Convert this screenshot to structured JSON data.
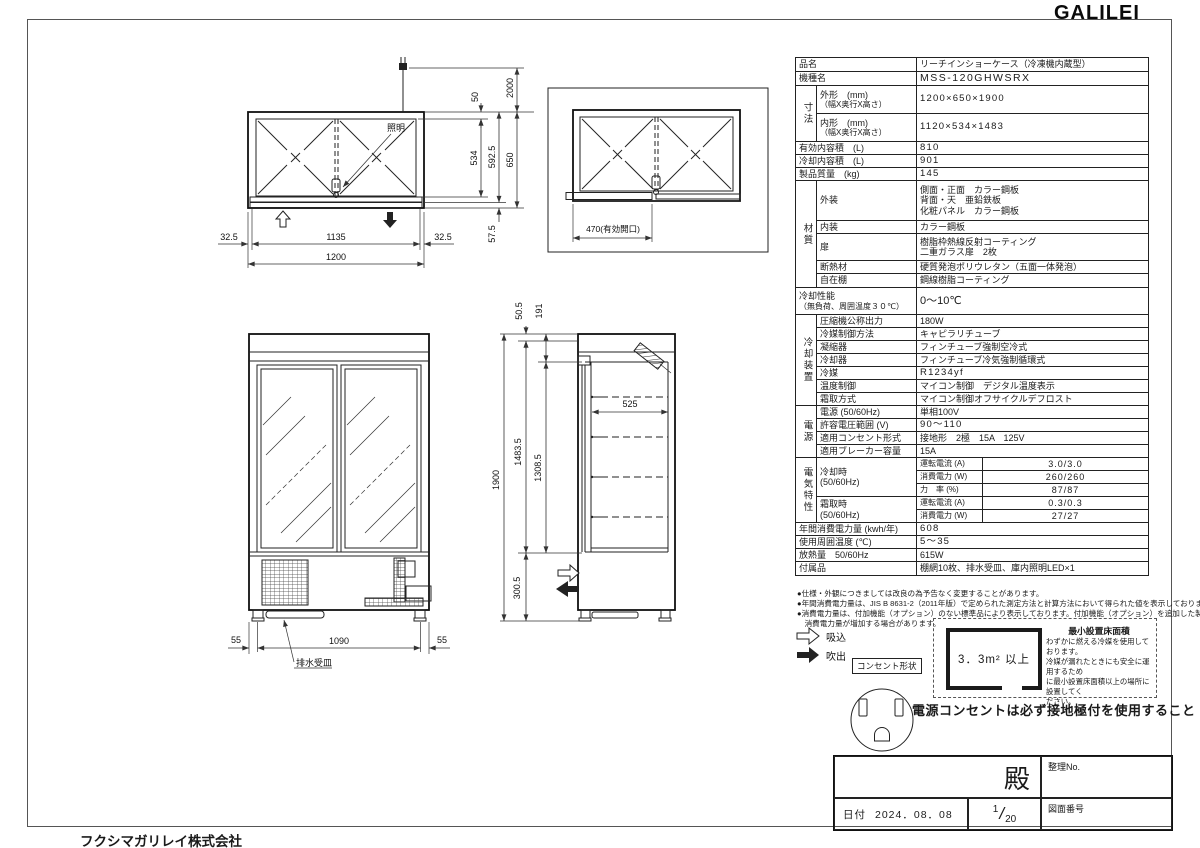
{
  "colors": {
    "ink": "#1a1a1a",
    "paper": "#ffffff"
  },
  "logo": "GALILEI",
  "company": "フクシマガリレイ株式会社",
  "spec": {
    "hinmei": {
      "label": "品名",
      "value": "リーチインショーケース（冷凍機内蔵型）"
    },
    "kishumei": {
      "label": "機種名",
      "value": "MSS-120GHWSRX"
    },
    "sunpou_group": "寸法",
    "gaikei": {
      "label": "外形　(mm)",
      "sub": "（幅X奥行X高さ）",
      "value": "1200×650×1900"
    },
    "naikei": {
      "label": "内形　(mm)",
      "sub": "（幅X奥行X高さ）",
      "value": "1120×534×1483"
    },
    "yuko_naiyoseki": {
      "label": "有効内容積　(L)",
      "value": "810"
    },
    "reikyaku_naiyoseki": {
      "label": "冷却内容積　(L)",
      "value": "901"
    },
    "seihin_shitsuryo": {
      "label": "製品質量　(kg)",
      "value": "145"
    },
    "zaishitsu_group": "材質",
    "gaisou": {
      "label": "外装",
      "lines": [
        "側面・正面　カラー鋼板",
        "背面・天　亜鉛鉄板",
        "化粧パネル　カラー鋼板"
      ]
    },
    "naisou": {
      "label": "内装",
      "value": "カラー鋼板"
    },
    "tobira": {
      "label": "扉",
      "lines": [
        "樹脂枠熱線反射コーティング",
        "二重ガラス扉　2枚"
      ]
    },
    "dannetsuzai": {
      "label": "断熱材",
      "value": "硬質発泡ポリウレタン（五面一体発泡）"
    },
    "jizaidana": {
      "label": "自在棚",
      "value": "鋼線樹脂コーティング"
    },
    "reikyaku_seino": {
      "label": "冷却性能",
      "sub": "（無負荷、周囲温度３０℃）",
      "value": "0～10℃"
    },
    "sochi_group": "冷却装置",
    "asshukuki": {
      "label": "圧縮機公称出力",
      "value": "180W"
    },
    "reibai_seigyo": {
      "label": "冷媒制御方法",
      "value": "キャピラリチューブ"
    },
    "gyoshukuki": {
      "label": "凝縮器",
      "value": "フィンチューブ強制空冷式"
    },
    "reikyakuki": {
      "label": "冷却器",
      "value": "フィンチューブ冷気強制循環式"
    },
    "reibai": {
      "label": "冷媒",
      "value": "R1234yf"
    },
    "ondo_seigyo": {
      "label": "温度制御",
      "value": "マイコン制御　デジタル温度表示"
    },
    "shimotori": {
      "label": "霜取方式",
      "value": "マイコン制御オフサイクルデフロスト"
    },
    "dengen_group": "電源",
    "dengen": {
      "label": "電源 (50/60Hz)",
      "value": "単相100V"
    },
    "kyoyo_denatsu": {
      "label": "許容電圧範囲 (V)",
      "value": "90～110"
    },
    "consent_keishiki": {
      "label": "適用コンセント形式",
      "value": "接地形　2極　15A　125V"
    },
    "breaker": {
      "label": "適用ブレーカー容量",
      "value": "15A"
    },
    "denki_group": "電気特性",
    "reikyakuji": {
      "label": "冷却時",
      "sub": "(50/60Hz)"
    },
    "shimotoriji": {
      "label": "霜取時",
      "sub": "(50/60Hz)"
    },
    "unten_denryu": "運転電流 (A)",
    "shohi_denryoku": "消費電力 (W)",
    "rikiritsu": "力　率 (%)",
    "cool_current": "3.0/3.0",
    "cool_power": "260/260",
    "cool_pf": "87/87",
    "defrost_current": "0.3/0.3",
    "defrost_power": "27/27",
    "nenkan": {
      "label": "年間消費電力量 (kwh/年)",
      "value": "608"
    },
    "shiyo_ondo": {
      "label": "使用周囲温度 (℃)",
      "value": "5～35"
    },
    "hounetsu": {
      "label": "放熱量　50/60Hz",
      "value": "615W"
    },
    "fuzokuhin": {
      "label": "付属品",
      "value": "棚網10枚、排水受皿、庫内照明LED×1"
    }
  },
  "notes_lines": [
    "●仕様・外観につきましては改良の為予告なく変更することがあります。",
    "●年間消費電力量は、JIS B 8631-2（2011年版）で定められた測定方法と計算方法において得られた値を表示しております",
    "●消費電力量は、付加機能（オプション）のない標準品により表示しております。付加機能（オプション）を追加した製品は、",
    "　消費電力量が増加する場合があります。"
  ],
  "legend": {
    "suction": "吸込",
    "blowout": "吹出"
  },
  "outlet_label": "コンセント形状",
  "ground_note": "電源コンセントは必ず接地極付を使用すること",
  "min_area": {
    "title": "最小設置床面積",
    "area": "3．3m² 以上",
    "note_lines": [
      "わずかに燃える冷媒を使用しております。",
      "冷媒が漏れたときにも安全に運用するため",
      "に最小設置床面積以上の場所に設置してく",
      "ださい。"
    ]
  },
  "title_block": {
    "dono": "殿",
    "seiri": "整理No.",
    "date_label": "日付",
    "date": "2024．08．08",
    "scale_num": "1",
    "scale_den": "20",
    "zuban": "図面番号"
  },
  "dims": {
    "lighting": "照明",
    "d50": "50",
    "d2000": "2000",
    "d534": "534",
    "d592_5": "592.5",
    "d650": "650",
    "d57_5": "57.5",
    "d32_5": "32.5",
    "d1135": "1135",
    "d1200": "1200",
    "opening": "470(有効開口)",
    "d55": "55",
    "d1090": "1090",
    "drain": "排水受皿",
    "d50_5": "50.5",
    "d191": "191",
    "d1900": "1900",
    "d1483_5": "1483.5",
    "d1308_5": "1308.5",
    "d525": "525",
    "d300_5": "300.5"
  }
}
